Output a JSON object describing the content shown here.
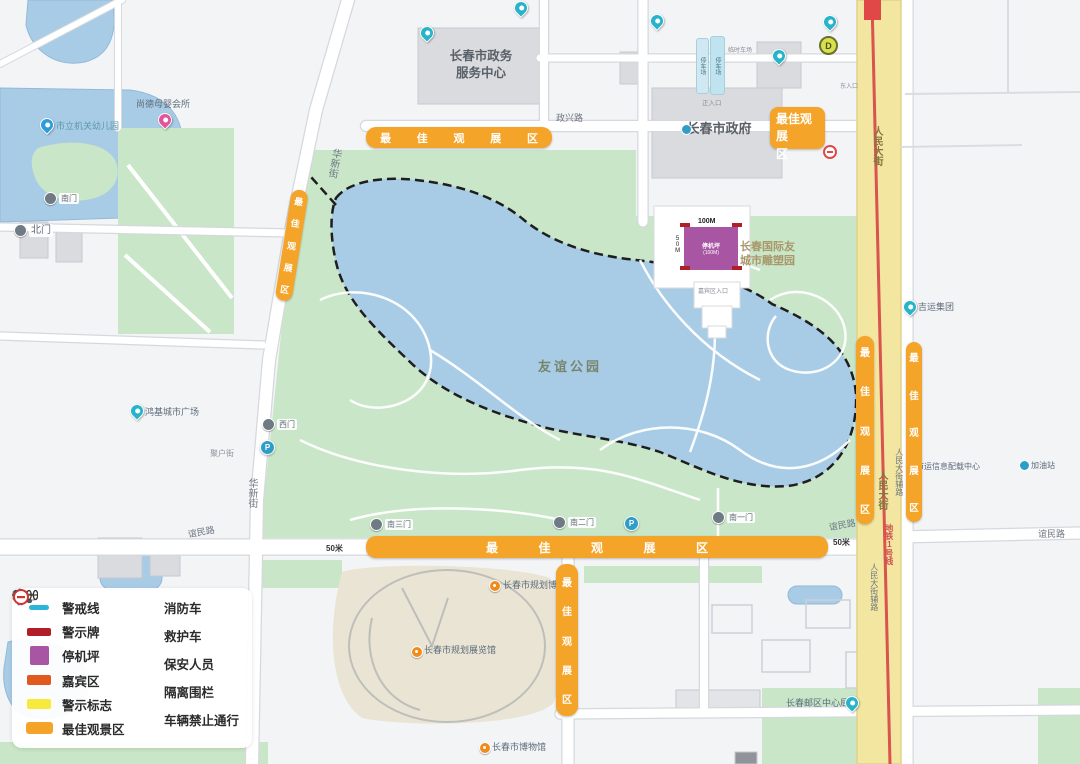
{
  "map": {
    "park_name": "友谊公园",
    "banner_text": "最佳观展区",
    "banner_box": {
      "line1": "最佳观展",
      "line2": "区"
    },
    "scale_50m_left": "50米",
    "scale_50m_right": "50米",
    "roads": {
      "renmin": "人民大街",
      "renmin_fulu": "人民大街辅路",
      "metro_line1": "地铁1号线",
      "zhengxing": "政兴路",
      "huaxin": "华新街",
      "yimin": "谊民路"
    },
    "gates": {
      "north": "北门",
      "south": "南门",
      "west": "西门",
      "south1": "南一门",
      "south2": "南二门",
      "south3": "南三门"
    },
    "pois": {
      "gov_service_line1": "长春市政务",
      "gov_service_line2": "服务中心",
      "city_gov": "长春市政府",
      "kindergarten": "市立机关幼儿园",
      "muying_club": "尚德母婴会所",
      "hongji_plaza": "鸿基城市广场",
      "juhu_street": "聚户街",
      "sculpture_line1": "长春国际友",
      "sculpture_line2": "城市雕塑园",
      "planning_museum": "长春市规划博物馆",
      "planning_hall": "长春市规划展览馆",
      "city_museum": "长春市博物馆",
      "post_center": "长春邮区中心局",
      "jiyun_group": "吉运集团",
      "info_center": "市运信息配载中心",
      "gas_station": "加油站",
      "main_entrance": "正入口",
      "east_entrance": "东入口",
      "vip_entrance": "嘉宾区入口",
      "parking_1": "停车场",
      "parking_2": "停车场",
      "parking_temp": "临时车场",
      "metro_exit_d": "D"
    },
    "helipad": {
      "label_line1": "停机坪",
      "label_line2": "(100M)",
      "width_label": "100M",
      "side_label": "50M"
    }
  },
  "legend": {
    "left": [
      {
        "label": "警戒线",
        "color": "#29B6D8",
        "type": "line"
      },
      {
        "label": "警示牌",
        "color": "#B21E28",
        "type": "bar"
      },
      {
        "label": "停机坪",
        "color": "#A855A3",
        "type": "square"
      },
      {
        "label": "嘉宾区",
        "color": "#E2591D",
        "type": "bar"
      },
      {
        "label": "警示标志",
        "color": "#F7EA3C",
        "type": "bar"
      },
      {
        "label": "最佳观景区",
        "color": "#F4A428",
        "type": "bar"
      }
    ],
    "right": [
      {
        "label": "消防车",
        "icon": "fire-truck-icon"
      },
      {
        "label": "救护车",
        "icon": "ambulance-icon"
      },
      {
        "label": "保安人员",
        "icon": "security-person-icon"
      },
      {
        "label": "隔离围栏",
        "icon": "isolation-fence-icon"
      },
      {
        "label": "车辆禁止通行",
        "icon": "no-vehicles-icon"
      }
    ]
  },
  "colors": {
    "banner_orange": "#F4A428",
    "helipad_purple": "#A855A3",
    "metro_red": "#D9534F",
    "water_blue": "#A9CCE6",
    "park_green": "#C9E6C8",
    "road_yellow": "#F3E6A0",
    "warning_red": "#B21E28",
    "guest_orange_red": "#E2591D",
    "warning_yellow": "#F7EA3C",
    "cordon_cyan": "#29B6D8"
  }
}
